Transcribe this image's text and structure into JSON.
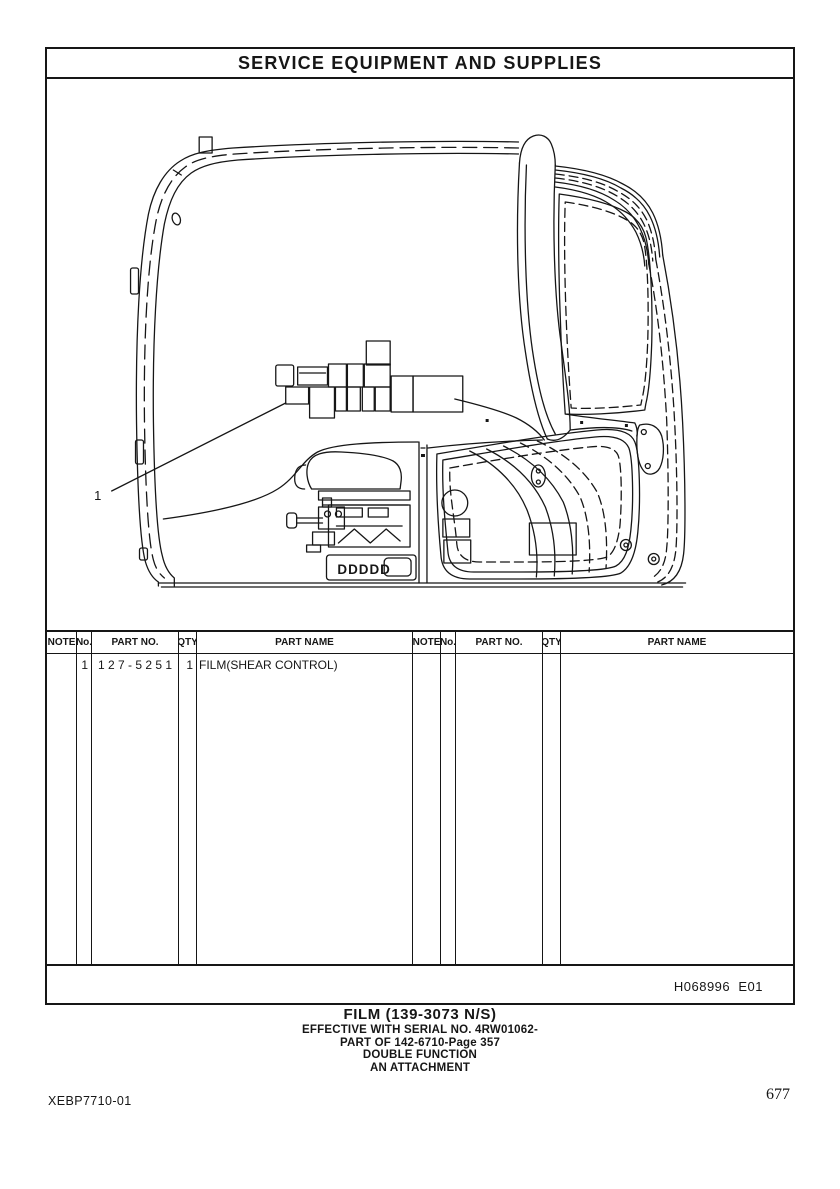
{
  "document": {
    "title": "SERVICE EQUIPMENT AND SUPPLIES",
    "figure_code": "H068996  E01",
    "doc_code": "XEBP7710-01",
    "page_number": "677"
  },
  "drawing": {
    "callout_label": "1",
    "vent_text": "DDDDD"
  },
  "parts_table": {
    "headers": {
      "note": "NOTE",
      "no": "No.",
      "part_no": "PART NO.",
      "qty": "QTY",
      "part_name": "PART NAME"
    },
    "rows": [
      {
        "note": "",
        "no": "1",
        "part_no": "1 2 7 - 5 2 5 1",
        "qty": "1",
        "part_name": "FILM(SHEAR CONTROL)"
      }
    ]
  },
  "caption": {
    "line1": "FILM (139-3073 N/S)",
    "line2": "EFFECTIVE WITH SERIAL NO. 4RW01062-",
    "line3": "PART OF 142-6710-Page 357",
    "line4": "DOUBLE FUNCTION",
    "line5": "AN ATTACHMENT"
  },
  "colors": {
    "ink": "#161616",
    "paper": "#ffffff"
  }
}
